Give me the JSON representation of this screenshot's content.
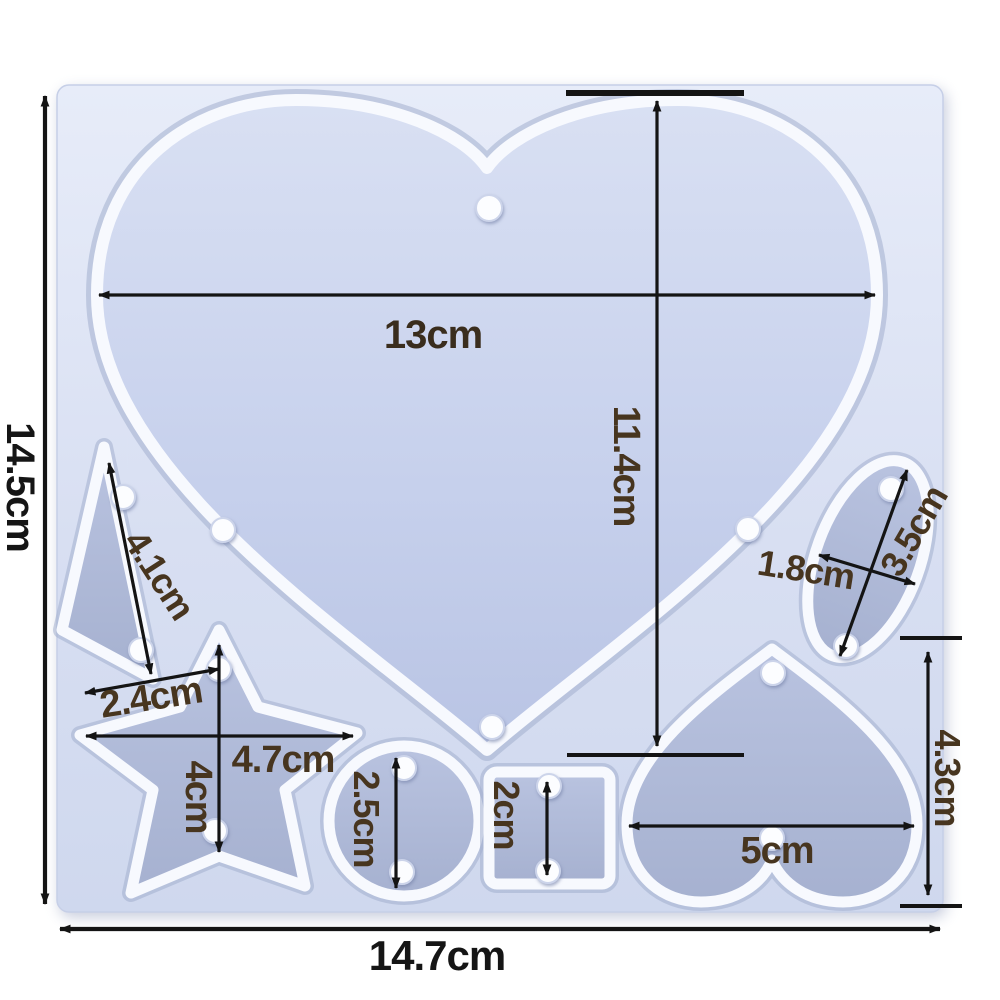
{
  "image_kind": "silicone resin mold product photo with dimension annotations",
  "colors": {
    "background": "#ffffff",
    "mold_silicone_light": "#e6ebf8",
    "mold_silicone_dark": "#d0d9ee",
    "cavity_floor": "#aab5d3",
    "ridge_white": "#f7f9fe",
    "dimension_line": "#141414",
    "label_brown": "#47351f",
    "label_black": "#151515"
  },
  "mold": {
    "overall_width_label": "14.7cm",
    "overall_height_label": "14.5cm"
  },
  "cavities": [
    {
      "name": "large-heart",
      "width": "13cm",
      "height": "11.4cm"
    },
    {
      "name": "triangle",
      "diagonal": "4.1cm",
      "base": "2.4cm"
    },
    {
      "name": "star",
      "width": "4.7cm",
      "height": "4cm"
    },
    {
      "name": "circle",
      "diameter": "2.5cm"
    },
    {
      "name": "square",
      "side": "2cm"
    },
    {
      "name": "small-heart",
      "width": "5cm",
      "height": "4.3cm"
    },
    {
      "name": "oval",
      "length": "3.5cm",
      "width": "1.8cm"
    }
  ],
  "measurements": {
    "overall_height": {
      "text": "14.5cm",
      "cm": 14.5
    },
    "overall_width": {
      "text": "14.7cm",
      "cm": 14.7
    },
    "heart_width": {
      "text": "13cm",
      "cm": 13
    },
    "heart_height": {
      "text": "11.4cm",
      "cm": 11.4
    },
    "triangle_diagonal": {
      "text": "4.1cm",
      "cm": 4.1
    },
    "triangle_base": {
      "text": "2.4cm",
      "cm": 2.4
    },
    "star_width": {
      "text": "4.7cm",
      "cm": 4.7
    },
    "star_height": {
      "text": "4cm",
      "cm": 4
    },
    "circle_diameter": {
      "text": "2.5cm",
      "cm": 2.5
    },
    "square_side": {
      "text": "2cm",
      "cm": 2
    },
    "small_heart_width": {
      "text": "5cm",
      "cm": 5
    },
    "small_heart_height": {
      "text": "4.3cm",
      "cm": 4.3
    },
    "oval_length": {
      "text": "3.5cm",
      "cm": 3.5
    },
    "oval_width": {
      "text": "1.8cm",
      "cm": 1.8
    }
  }
}
